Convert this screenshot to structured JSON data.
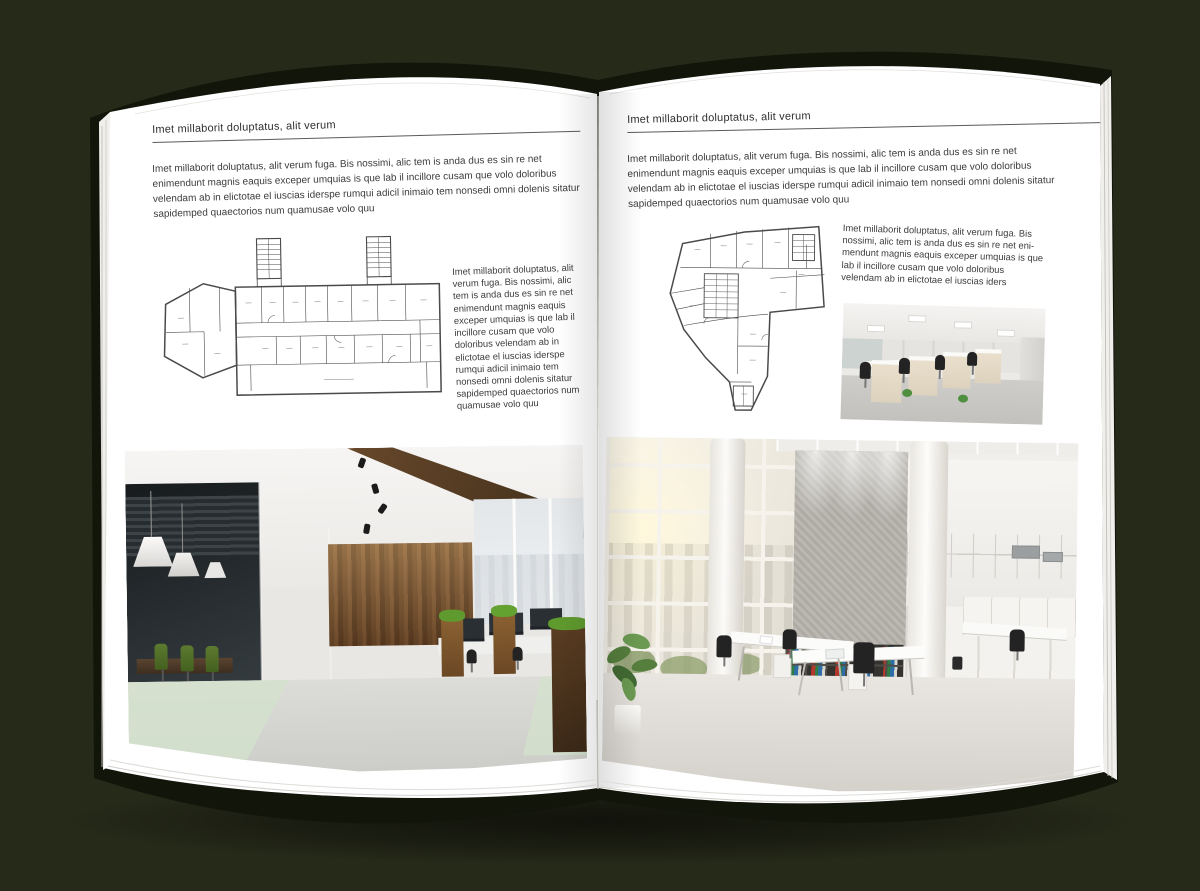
{
  "scene": {
    "background_color": "#262a19",
    "cover_color": "#12150a",
    "page_color": "#ffffff"
  },
  "left_page": {
    "header": "Imet millaborit doluptatus, alit verum",
    "intro": "Imet millaborit doluptatus, alit verum fuga. Bis nossimi, alic tem is anda dus es sin re net enimendunt magnis eaquis exceper umquias is que lab il incillore cusam que volo doloribus velendam ab in elictotae el iuscias iderspe rumqui adicil inimaio tem nonsedi omni dolenis sitatur sapidemped quaectorios num quamusae volo quu",
    "caption": "Imet millaborit doluptatus, alit verum fuga. Bis nossimi, alic tem is anda dus es sin re net enimendunt magnis eaquis exceper umquias is que lab il incillore cusam que volo doloribus velendam ab in elictotae el iuscias iderspe rumqui adicil inimaio tem nonsedi omni dolenis sitatur sapidemped quaectorios num quamusae volo quu",
    "floor_plan_name": "rectangular-office-building-floor-plan",
    "photo_name": "dark-wood-and-glass-office-interior"
  },
  "right_page": {
    "header": "Imet millaborit doluptatus, alit verum",
    "intro": "Imet millaborit doluptatus, alit verum fuga. Bis nossimi, alic tem is anda dus es sin re net enimendunt magnis eaquis exceper umquias is que lab il incillore cusam que volo doloribus velendam ab in elictotae el iuscias iderspe rumqui adicil inimaio tem nonsedi omni dolenis sitatur sapidemped quaectorios num quamusae volo quu",
    "caption": "Imet millaborit doluptatus, alit verum fuga. Bis nossimi, alic tem is anda dus es sin re net eni-mendunt magnis eaquis exceper umquias is que lab il incillore cusam que volo doloribus velendam ab in elictotae el iuscias iders",
    "floor_plan_name": "wedge-shaped-office-building-floor-plan",
    "photo_small_name": "white-office-workstations",
    "photo_name": "bright-atrium-office-interior"
  }
}
